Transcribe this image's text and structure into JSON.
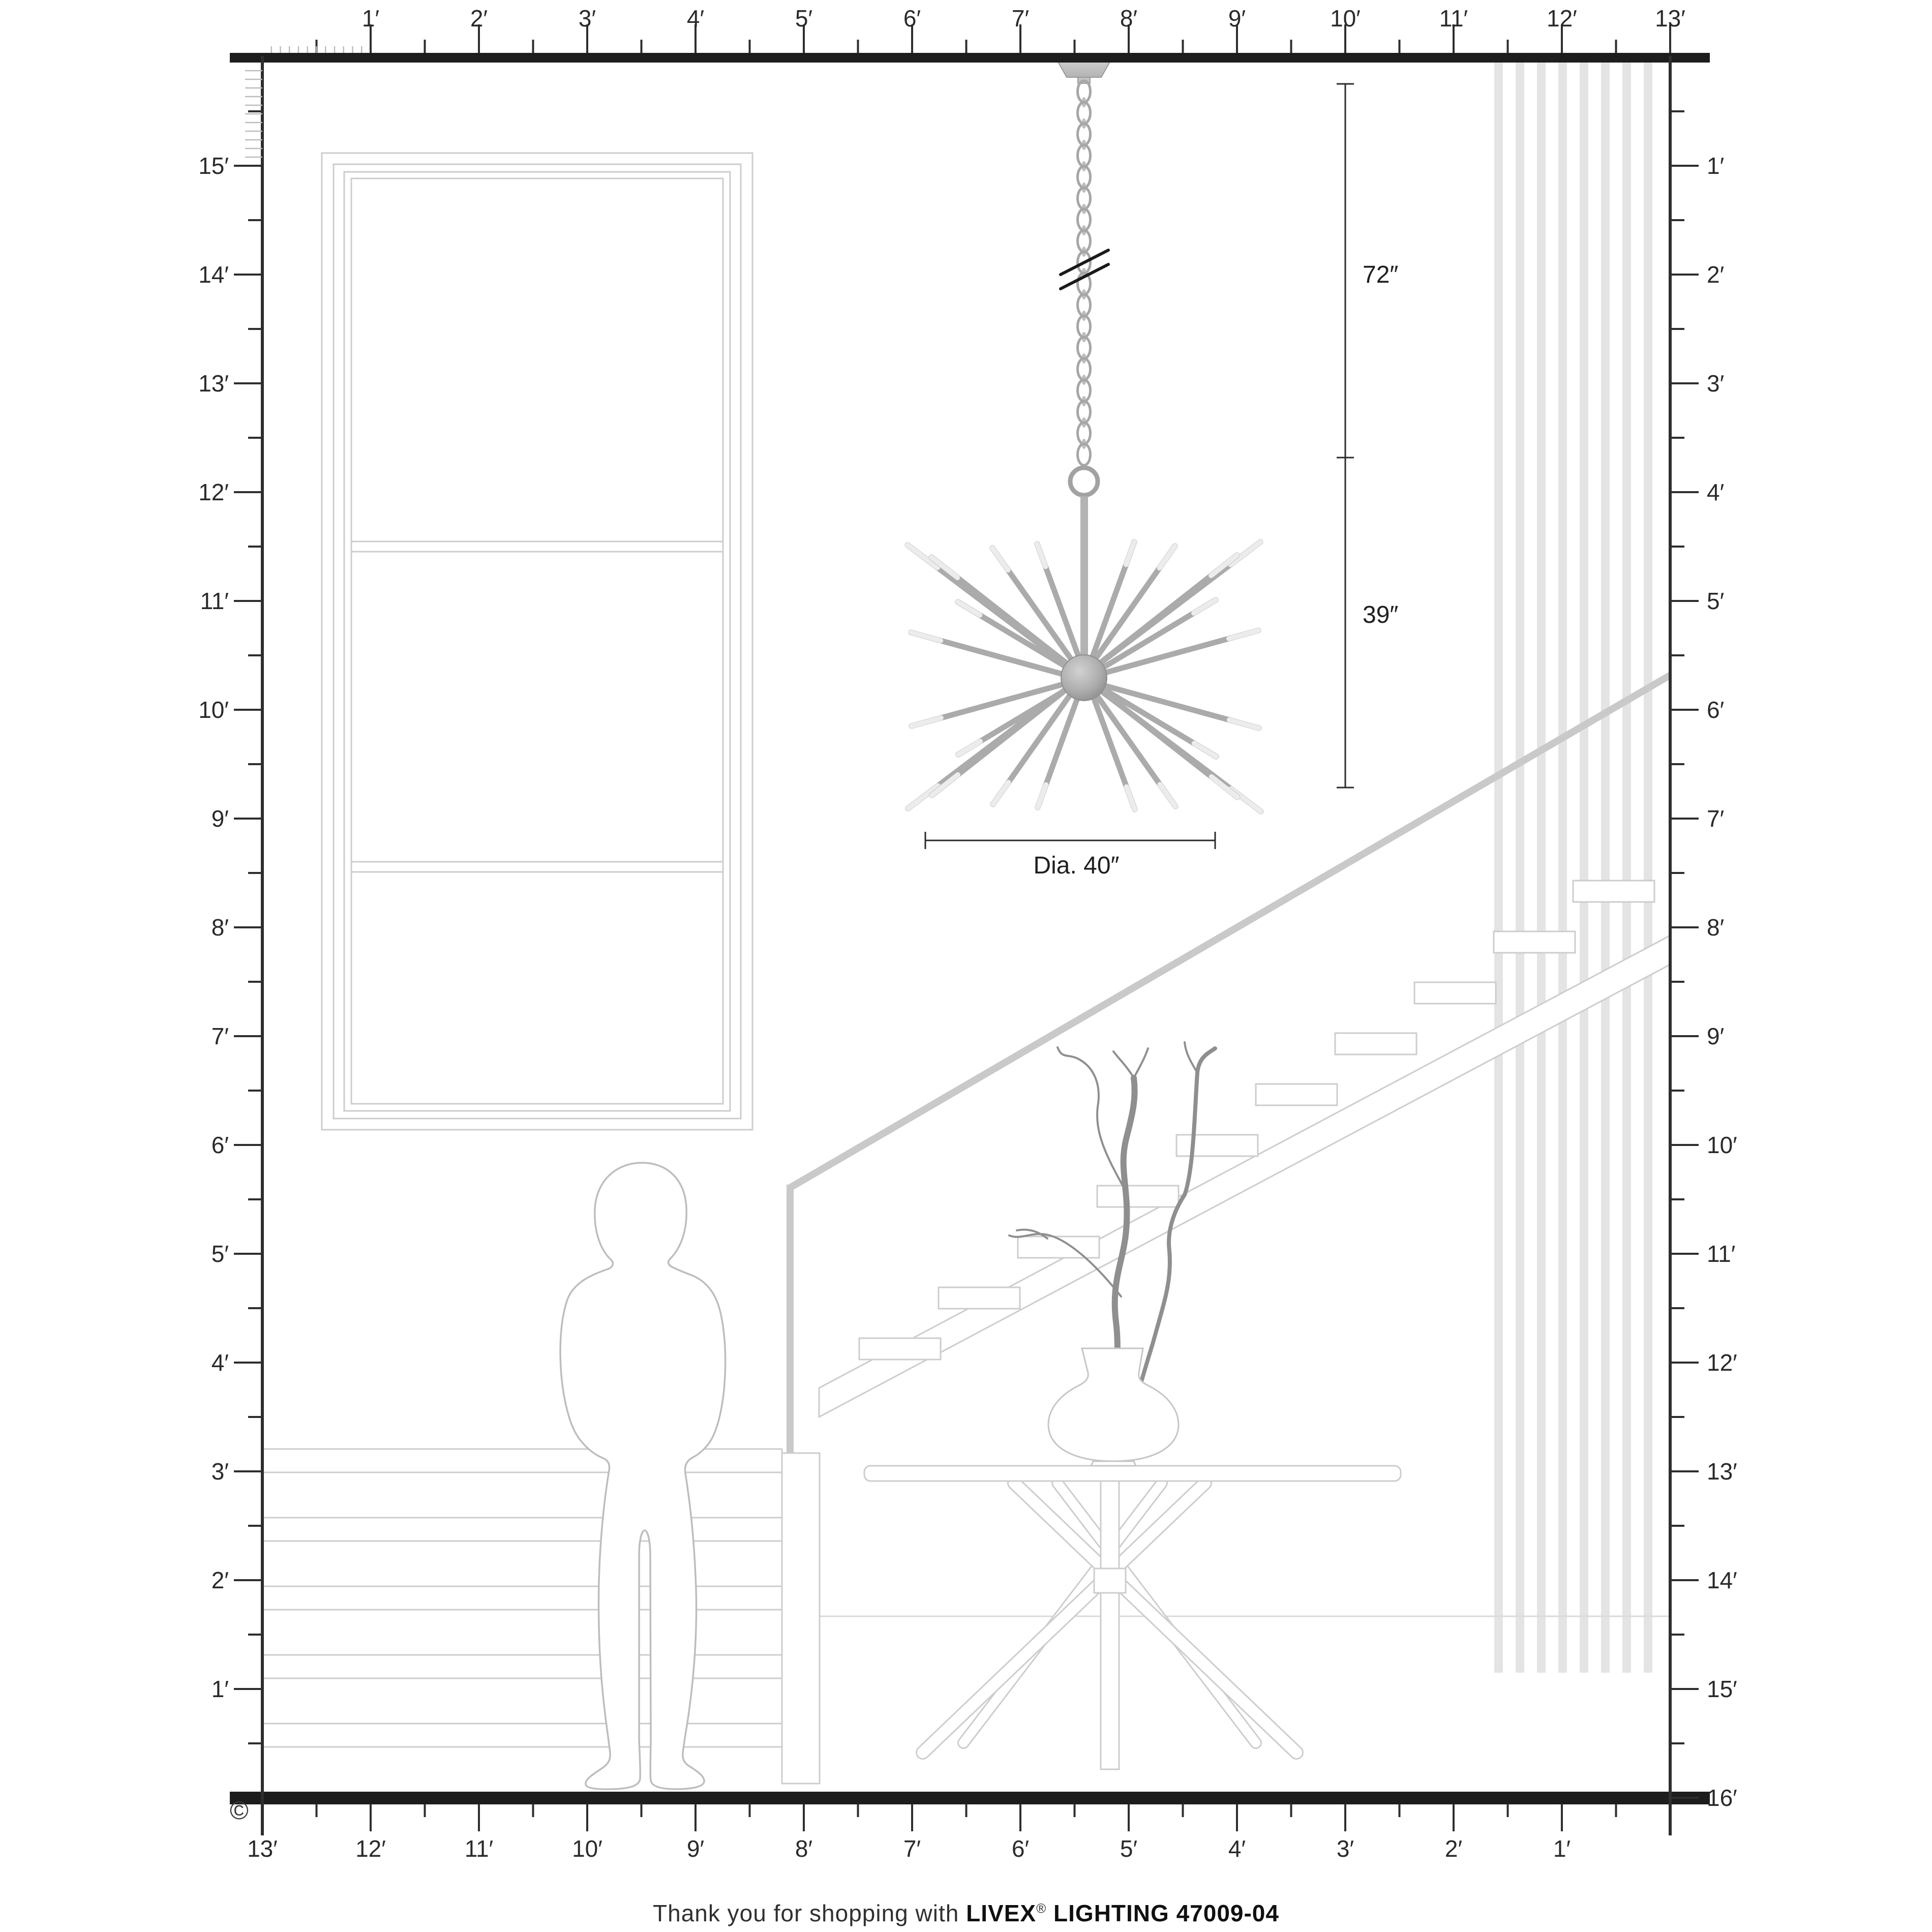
{
  "palette": {
    "ink": "#222222",
    "bar": "#1d1d1d",
    "tick": "#2e2e2e",
    "line_light": "#cdcdcd",
    "line_faint": "#e4e4e4",
    "metal": "#ababab",
    "metal_dark": "#8f8f8f",
    "branch": "#8f8f8f",
    "text": "#1f1f1f"
  },
  "rulers": {
    "top": {
      "labels": [
        "1′",
        "2′",
        "3′",
        "4′",
        "5′",
        "6′",
        "7′",
        "8′",
        "9′",
        "10′",
        "11′",
        "12′",
        "13′"
      ]
    },
    "left": {
      "labels": [
        "15′",
        "14′",
        "13′",
        "12′",
        "11′",
        "10′",
        "9′",
        "8′",
        "7′",
        "6′",
        "5′",
        "4′",
        "3′",
        "2′",
        "1′"
      ]
    },
    "right": {
      "labels": [
        "1′",
        "2′",
        "3′",
        "4′",
        "5′",
        "6′",
        "7′",
        "8′",
        "9′",
        "10′",
        "11′",
        "12′",
        "13′",
        "14′",
        "15′",
        "16′"
      ]
    },
    "bottom": {
      "labels": [
        "13′",
        "12′",
        "11′",
        "10′",
        "9′",
        "8′",
        "7′",
        "6′",
        "5′",
        "4′",
        "3′",
        "2′",
        "1′"
      ]
    }
  },
  "dimensions": {
    "drop": "72″",
    "fixture_height": "39″",
    "diameter": "Dia. 40″"
  },
  "footer": {
    "prefix": "Thank you for shopping with ",
    "brand": "LIVEX",
    "registered": "®",
    "suffix": " LIGHTING 47009-04"
  },
  "copyright": "©"
}
